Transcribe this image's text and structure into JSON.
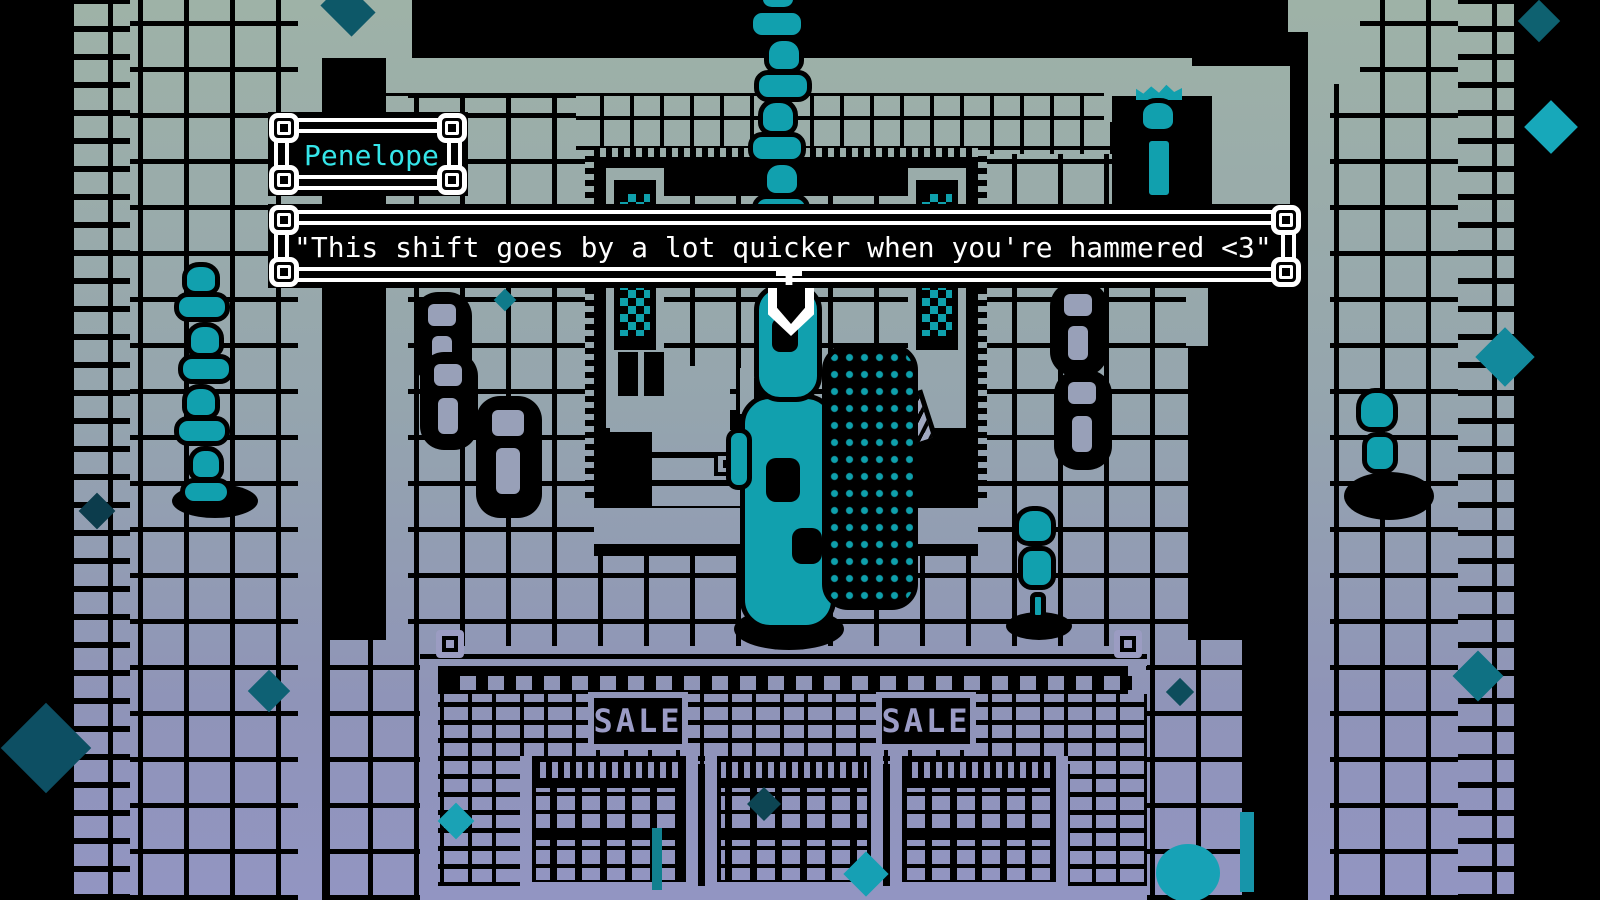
{
  "scene": {
    "description": "1-bit pixel-art RPG store interior, tinted green-grey to purple",
    "entities": [
      "customer-queue-top",
      "customer-queue-left",
      "penelope-clerk",
      "dark-customer-at-counter",
      "statue-npc",
      "walking-customer",
      "corridor-customer"
    ]
  },
  "dialogue": {
    "speaker_name": "Penelope",
    "line": "\"This shift goes by a lot quicker when you're hammered <3\"",
    "continue_indicator": "down-arrow"
  },
  "store": {
    "sale_signs": [
      {
        "label": "SALE"
      },
      {
        "label": "SALE"
      }
    ]
  },
  "palette": {
    "background": "#000000",
    "surface_top": "#9eb2a7",
    "surface_mid": "#95a5ae",
    "surface_bottom": "#9295c2",
    "character_teal": "#11a0ae",
    "speaker_name_color": "#35e5e9",
    "dialogue_text_color": "#ffffff",
    "frame_color": "#ffffff"
  }
}
